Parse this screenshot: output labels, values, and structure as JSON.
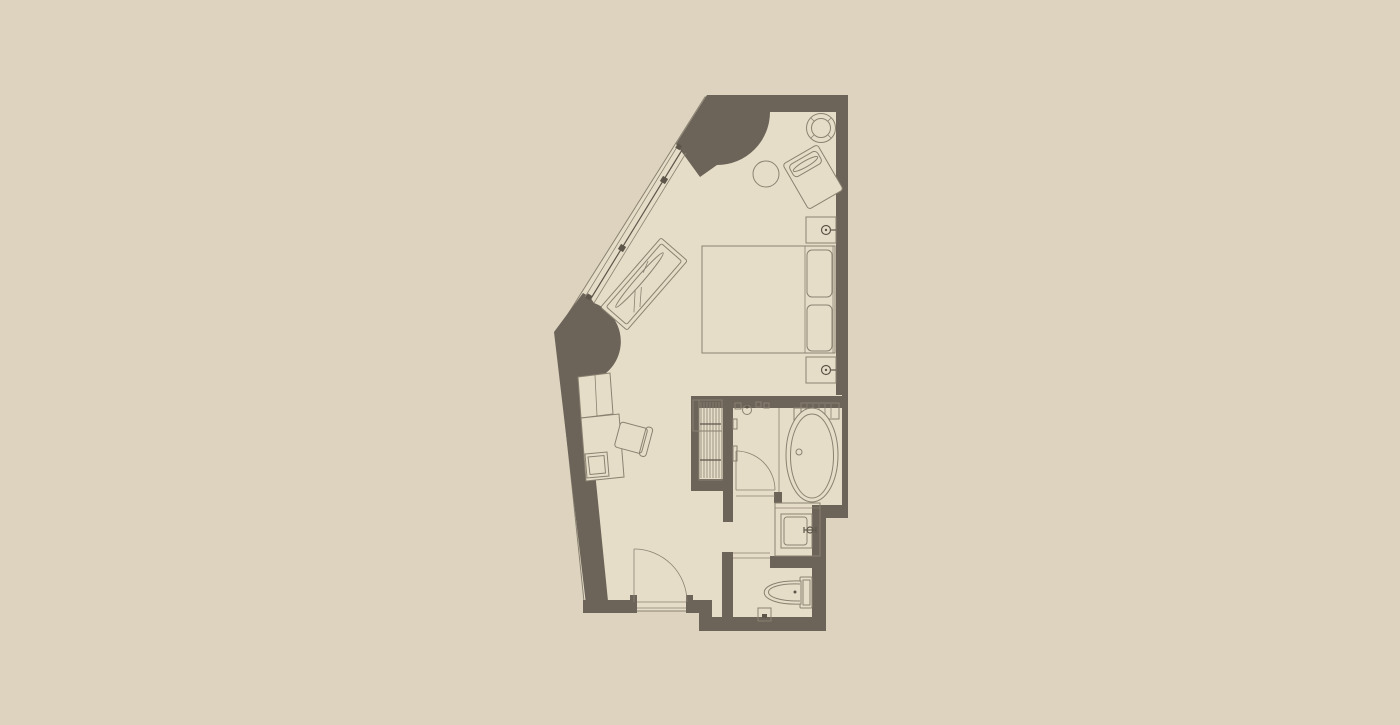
{
  "page": {
    "kind": "architectural floor plan drawing",
    "description": "Top-down plan of a hotel guest room with a diagonal glazed wall, bedroom, hallway, closet, bathroom with freestanding bathtub, washbasin niche and separate WC",
    "width_px": 1400,
    "height_px": 725
  },
  "colors": {
    "bg": "#ddd3bf",
    "floor": "#e6ddc8",
    "wall": "#6c6459",
    "line": "#8a8171",
    "line-dark": "#5e564b",
    "glass": "#4a443c"
  },
  "plan": {
    "rooms": [
      {
        "name": "bedroom"
      },
      {
        "name": "hallway"
      },
      {
        "name": "closet"
      },
      {
        "name": "bathroom"
      },
      {
        "name": "washbasin-niche"
      },
      {
        "name": "wc"
      }
    ],
    "architecture": [
      "diagonal window wall with centre glazing line and two mullion marks",
      "curved curtain pocket at top corner of window wall",
      "curved curtain pocket at bottom corner of window wall",
      "stepped exterior wall on right side",
      "entry door swinging into hallway",
      "bathroom door swinging into bathroom",
      "open threshold into wc"
    ],
    "furniture": [
      "round pedestal table",
      "side table",
      "armchair",
      "chaise longue",
      "double bed with two pillows and headboard",
      "nightstand with table lamp (upper)",
      "nightstand with table lamp (lower)",
      "two-door cabinet",
      "desk with tray",
      "desk chair",
      "wardrobe rail with hangers",
      "freestanding oval bathtub",
      "bath shelf with slats",
      "bath filler fixture",
      "shower fittings",
      "vanity washbasin with mixer tap",
      "toilet with cistern",
      "toilet paper holder"
    ]
  }
}
